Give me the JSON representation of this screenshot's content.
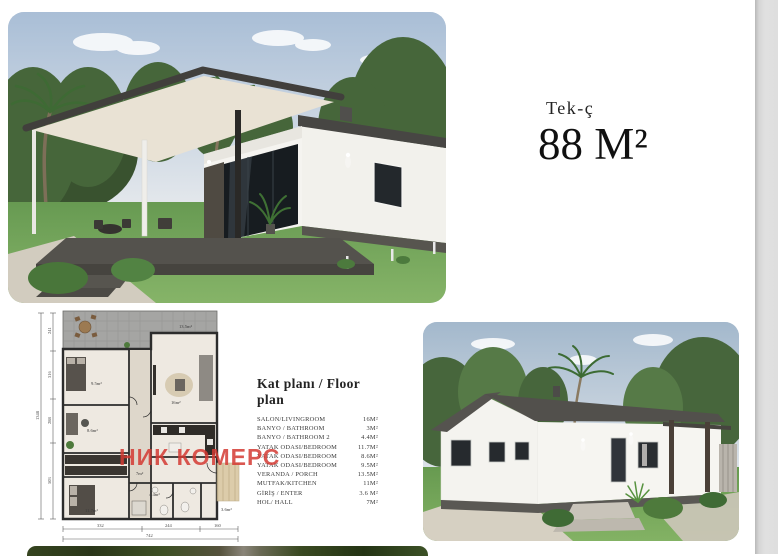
{
  "page": {
    "type_label": "Tek-ç",
    "area_label": "88 M²",
    "watermark_text": "НИК КОМЕРС"
  },
  "floor_plan_list": {
    "heading": "Kat planı / Floor plan",
    "rooms": [
      {
        "label": "SALON/LIVINGROOM",
        "area": "16M²"
      },
      {
        "label": "BANYO / BATHROOM",
        "area": "3M²"
      },
      {
        "label": "BANYO / BATHROOM 2",
        "area": "4.4M²"
      },
      {
        "label": "YATAK ODASI/BEDROOM",
        "area": "11.7M²"
      },
      {
        "label": "YATAK ODASI/BEDROOM",
        "area": "8.6M²"
      },
      {
        "label": "YATAK ODASI/BEDROOM",
        "area": "9.5M²"
      },
      {
        "label": "VERANDA / PORCH",
        "area": "13.5M²"
      },
      {
        "label": "MUTFAK/KITCHEN",
        "area": "11M²"
      },
      {
        "label": "GİRİŞ / ENTER",
        "area": "3.6 M²"
      },
      {
        "label": "HOL/ HALL",
        "area": "7M²"
      }
    ]
  },
  "plan_drawing": {
    "vertical_dims": [
      "241",
      "316",
      "288",
      "503"
    ],
    "vertical_total": "1348",
    "horizontal_dims": [
      "332",
      "244",
      "160"
    ],
    "horizontal_total": "742",
    "room_labels": {
      "veranda": "13.5m²",
      "living": "16m²",
      "bedroom_top": "9.5m²",
      "bedroom_mid": "8.6m²",
      "bedroom_bottom": "11.7m²",
      "hall": "7m²",
      "bathroom": "4.4m²",
      "entry": "3.6m²"
    }
  },
  "colors": {
    "watermark_red": "#d33932",
    "page_background": "#ffffff",
    "viewer_gutter": "#dedede",
    "text_dark": "#181818"
  }
}
